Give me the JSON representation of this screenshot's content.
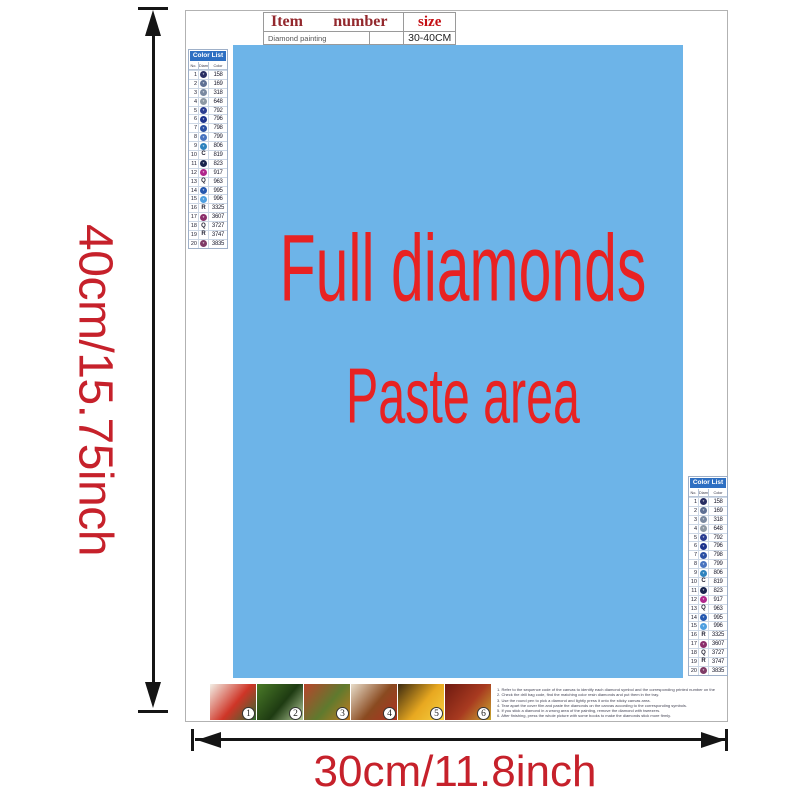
{
  "item_table": {
    "headers": [
      "Item",
      "number",
      "size"
    ],
    "row": [
      "Diamond painting",
      "",
      "30-40CM"
    ]
  },
  "paste_area": {
    "line1": "Full diamonds",
    "line2": "Paste area"
  },
  "dimensions": {
    "height_label": "40cm/15.75inch",
    "width_label": "30cm/11.8inch"
  },
  "colors": {
    "paste_bg": "#6db4e8",
    "paste_text_red": "#e82222",
    "dimension_red": "#c6212b",
    "list_header_blue": "#2e6fc2",
    "table_header_maroon": "#93282d",
    "table_size_red": "#c40f14",
    "arrow_black": "#151515"
  },
  "color_list": {
    "title": "Color List",
    "columns": [
      "No.",
      "Diamond",
      "Color"
    ],
    "rows": [
      {
        "no": "1",
        "glyph": "*",
        "type": "circle",
        "color": "#282e63",
        "code": "158"
      },
      {
        "no": "2",
        "glyph": "*",
        "type": "circle",
        "color": "#5e7094",
        "code": "169"
      },
      {
        "no": "3",
        "glyph": "*",
        "type": "circle",
        "color": "#7a89a0",
        "code": "318"
      },
      {
        "no": "4",
        "glyph": "*",
        "type": "circle",
        "color": "#8e99a4",
        "code": "648"
      },
      {
        "no": "5",
        "glyph": "*",
        "type": "circle",
        "color": "#2b3d91",
        "code": "792"
      },
      {
        "no": "6",
        "glyph": "*",
        "type": "circle",
        "color": "#1d338d",
        "code": "796"
      },
      {
        "no": "7",
        "glyph": "*",
        "type": "circle",
        "color": "#2a4fa3",
        "code": "798"
      },
      {
        "no": "8",
        "glyph": "*",
        "type": "circle",
        "color": "#4873bf",
        "code": "799"
      },
      {
        "no": "9",
        "glyph": "*",
        "type": "circle",
        "color": "#2e83be",
        "code": "806"
      },
      {
        "no": "10",
        "glyph": "C",
        "type": "letter",
        "color": "#223",
        "code": "819"
      },
      {
        "no": "11",
        "glyph": "*",
        "type": "circle",
        "color": "#19254e",
        "code": "823"
      },
      {
        "no": "12",
        "glyph": "*",
        "type": "circle",
        "color": "#b0268c",
        "code": "917"
      },
      {
        "no": "13",
        "glyph": "Q",
        "type": "letter",
        "color": "#223",
        "code": "963"
      },
      {
        "no": "14",
        "glyph": "*",
        "type": "circle",
        "color": "#2457af",
        "code": "995"
      },
      {
        "no": "15",
        "glyph": "*",
        "type": "circle",
        "color": "#4e9fe0",
        "code": "996"
      },
      {
        "no": "16",
        "glyph": "R",
        "type": "letter",
        "color": "#223",
        "code": "3325"
      },
      {
        "no": "17",
        "glyph": "*",
        "type": "circle",
        "color": "#8b2e6b",
        "code": "3607"
      },
      {
        "no": "18",
        "glyph": "Q",
        "type": "letter",
        "color": "#223",
        "code": "3727"
      },
      {
        "no": "19",
        "glyph": "R",
        "type": "letter",
        "color": "#223",
        "code": "3747"
      },
      {
        "no": "20",
        "glyph": "*",
        "type": "circle",
        "color": "#7e3b66",
        "code": "3835"
      }
    ]
  },
  "steps": [
    {
      "label": "1",
      "colors": [
        "#f2efe6",
        "#cf3527",
        "#2f6b33"
      ]
    },
    {
      "label": "2",
      "colors": [
        "#4a7a28",
        "#1e3b12",
        "#b9cf9e"
      ]
    },
    {
      "label": "3",
      "colors": [
        "#b8442c",
        "#5f7a2e",
        "#c27a1e"
      ]
    },
    {
      "label": "4",
      "colors": [
        "#e8ddca",
        "#8a4a20",
        "#b03020"
      ]
    },
    {
      "label": "5",
      "colors": [
        "#3c2a10",
        "#e8a820",
        "#f5d040"
      ]
    },
    {
      "label": "6",
      "colors": [
        "#6e1a10",
        "#a83a20",
        "#c8a830"
      ]
    }
  ],
  "instructions": [
    "1. Refer to the sequence code of the canvas to identify each diamond symbol and the corresponding printed number on the canvas.",
    "2. Check the drill bag code, find the matching color resin diamonds and put them in the tray.",
    "3. Use the round pen to pick a diamond and lightly press it onto the sticky canvas area.",
    "4. Tear apart the cover film and paste the diamonds on the canvas according to the corresponding symbols.",
    "5. If you stick a diamond in a wrong area of the painting, remove the diamond with tweezers.",
    "6. After finishing, press the whole picture with some books to make the diamonds stick more firmly."
  ]
}
